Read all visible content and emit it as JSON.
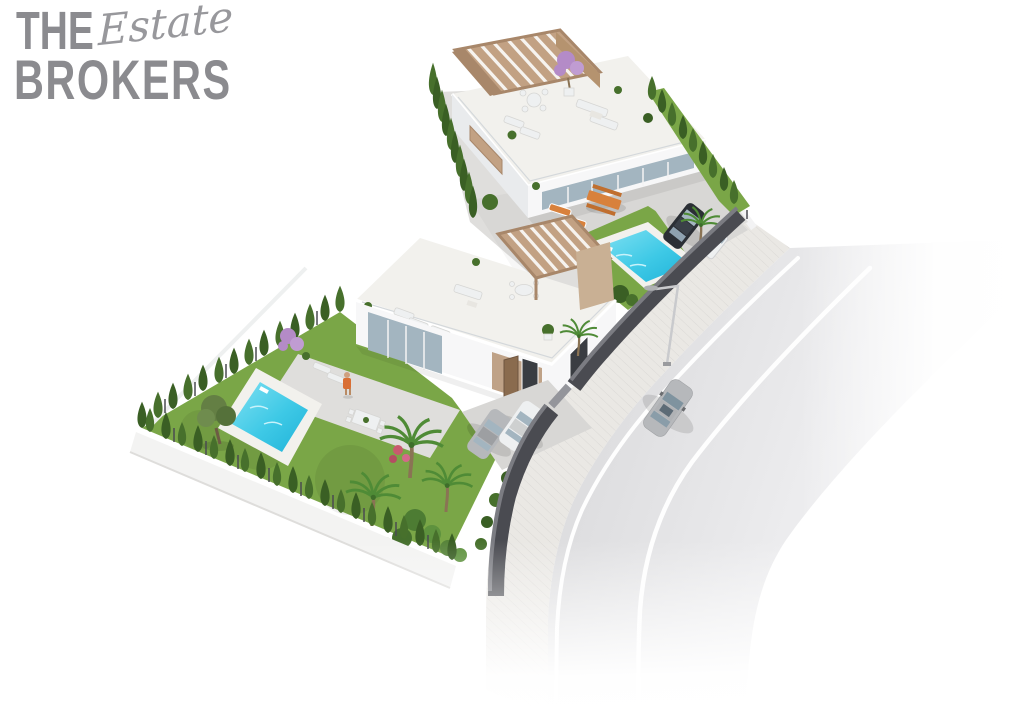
{
  "logo": {
    "word_top": "THE",
    "word_script": "Estate",
    "word_bottom": "BROKERS"
  },
  "palette": {
    "page_bg": "#ffffff",
    "logo_gray": "#8b8b8f",
    "logo_script": "#98989c",
    "patio": "#dfdedc",
    "ground": "#d8d7d5",
    "grass": "#7aa647",
    "grass_dark": "#699a39",
    "hedge": "#47702c",
    "hedge_dark": "#3a5f24",
    "water_light": "#7fe0f2",
    "water": "#3ec9e6",
    "water_deep": "#1fb2d8",
    "deck": "#f2f1ed",
    "road": "#d6d6d8",
    "road_far": "#ececee",
    "road_line": "#ffffff",
    "sidewalk": "#eae8e4",
    "wall": "#4a4b51",
    "wall_top": "#7b7c82",
    "fence_white": "#f3f3f4",
    "white_wall": "#f7f7f8",
    "shade_wall": "#e9ebed",
    "glass": "#a3b5c0",
    "wood": "#c2a183",
    "wood_mid": "#b5936f",
    "wood_dark": "#a8876a",
    "wood_light": "#f6f3ef",
    "tan_wall": "#c9b094",
    "entry_tan": "#bfa287",
    "door_wood": "#8a6b4e",
    "window_dark": "#3a3d42",
    "orange": "#d8813c",
    "orange_dark": "#c06f2f",
    "car_dark": "#2b2f35",
    "car_silver": "#b6b8bb",
    "car_white": "#eef0f1",
    "palm": "#4f8b36",
    "olive": "#647f44",
    "purple": "#b48bc7",
    "purple_light": "#c09cd2",
    "trunk": "#8a7354",
    "skin": "#cfa07f",
    "shirt": "#d96f35",
    "pink": "#c85a6e"
  }
}
